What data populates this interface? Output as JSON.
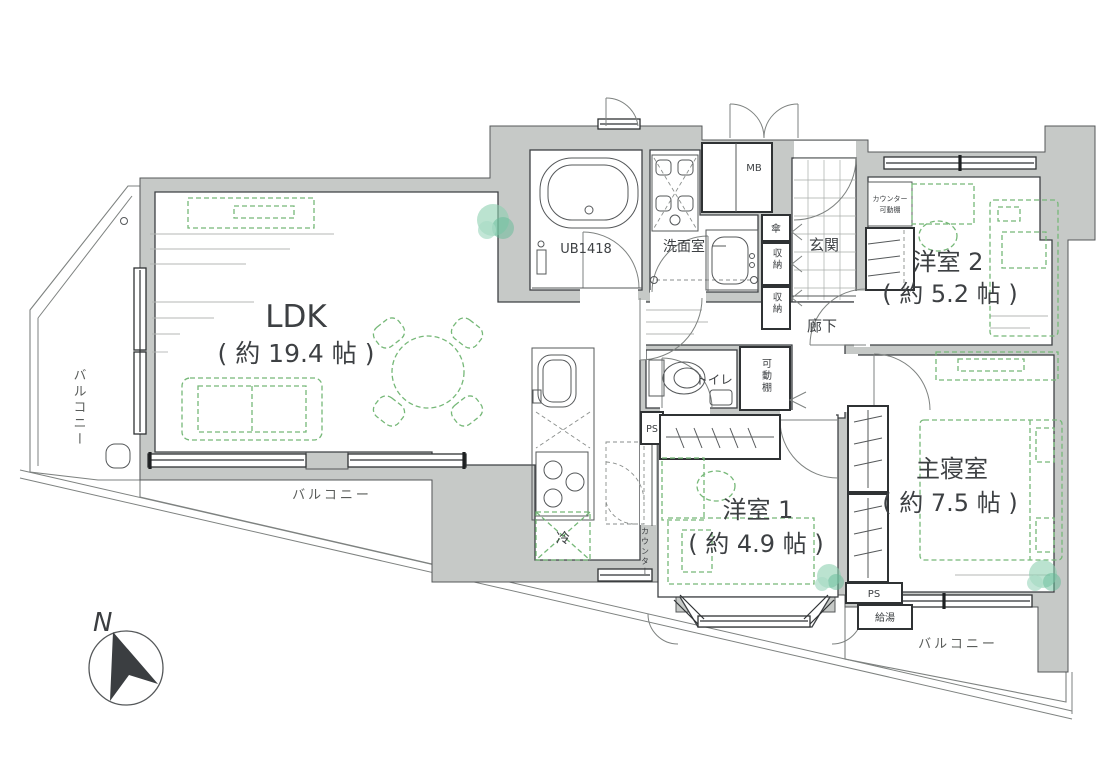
{
  "colors": {
    "wall": "#c6c9c7",
    "ink": "#3d4043",
    "green": "#76b878",
    "tree1": "#8ed0b0",
    "tree2": "#63bc98",
    "tree3": "#aadcc6"
  },
  "labels": {
    "ldk": {
      "name": "LDK",
      "size": "( 約 19.4 帖 )"
    },
    "western2": {
      "name": "洋室 2",
      "size": "( 約 5.2 帖 )"
    },
    "master": {
      "name": "主寝室",
      "size": "( 約 7.5 帖 )"
    },
    "western1": {
      "name": "洋室 1",
      "size": "( 約 4.9 帖 )"
    },
    "entrance": "玄関",
    "hallway": "廊下",
    "washroom": "洗面室",
    "bath": "UB1418",
    "toilet": "トイレ",
    "balcony_left": "バルコニー",
    "balcony_bottom": "バルコニー",
    "balcony_right": "バルコニー",
    "meter_box": "MB",
    "ps_left": "PS",
    "ps_right": "PS",
    "water_heater": "給湯",
    "fridge": "冷",
    "counter": "カウンター",
    "umbrella": "傘",
    "storage_upper": "収納",
    "storage_lower": "収納",
    "movable_shelf": "可動棚",
    "counter_shelf_l1": "カウンター",
    "counter_shelf_l2": "可動棚",
    "north": "N"
  }
}
